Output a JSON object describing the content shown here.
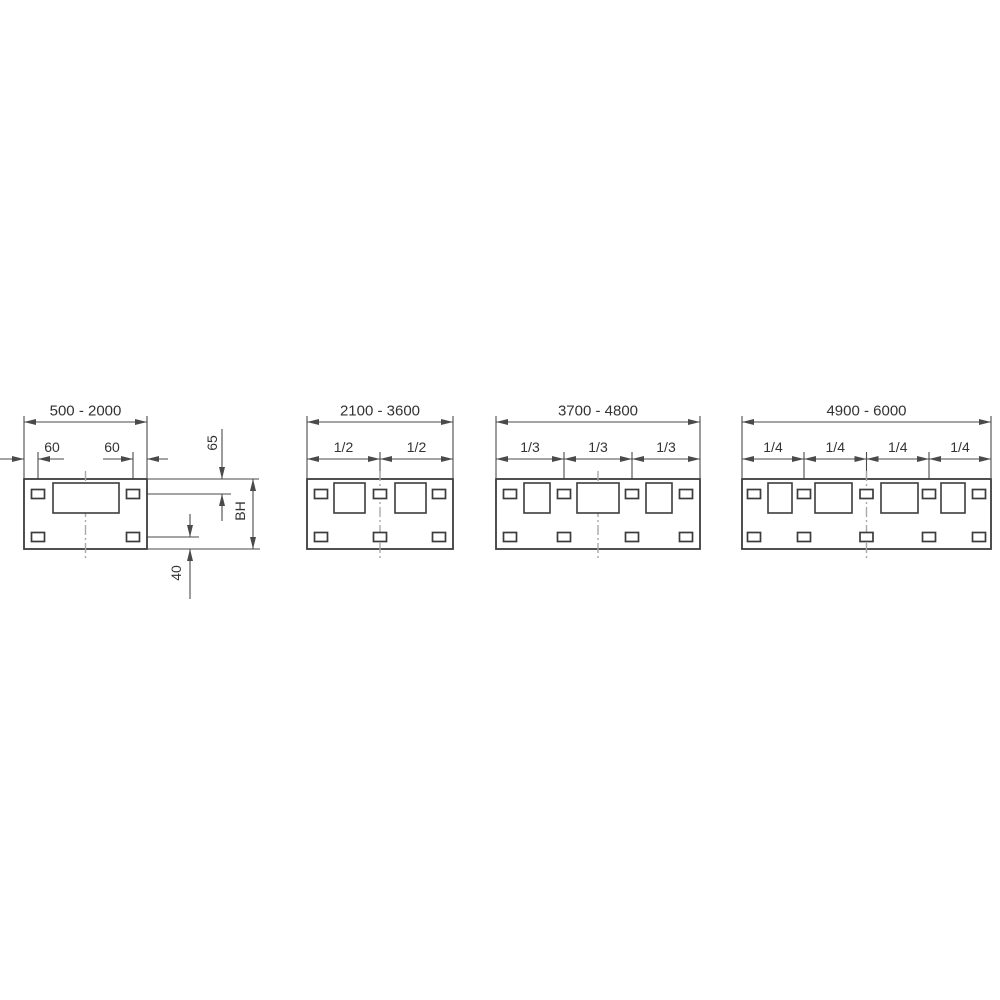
{
  "drawing": {
    "description_labels": {
      "range_labels": [
        "500 - 2000",
        "2100 - 3600",
        "3700 - 4800",
        "4900 - 6000"
      ],
      "fraction_labels": [
        "1/2",
        "1/3",
        "1/4"
      ],
      "offset_labels": [
        "60",
        "60"
      ],
      "side_labels": [
        "65",
        "BH",
        "40"
      ]
    },
    "styles": {
      "outline_color": "#3c3c3c",
      "dim_color": "#4a4a4a",
      "centerline_color": "#a8a8a8",
      "text_color": "#333333",
      "background": "#ffffff"
    },
    "layout": {
      "frame_y1": 479,
      "frame_y2": 549,
      "dim_line_y": 422,
      "range_label_y": 411,
      "sub_dim_y": 459,
      "sub_label_y": 447,
      "ext_top_y": 416,
      "div_ext_y1": 452,
      "slot_w": 13,
      "slot_h": 9,
      "slot_row_top_y": 494,
      "slot_row_bottom_y": 537,
      "cutout_y1": 483,
      "cutout_y2": 513,
      "centerline_y1": 471,
      "centerline_y2": 558,
      "range_font": 15,
      "sub_font": 14,
      "arrow_len": 12,
      "arrow_halfwidth": 3
    },
    "panels": [
      {
        "id": "500-2000",
        "range_label": "500 - 2000",
        "x1": 24,
        "x2": 147,
        "center_x": 85.5,
        "slots_x": [
          38,
          133
        ],
        "cutouts": [
          [
            53,
            119
          ]
        ],
        "divisions": [],
        "division_label": "",
        "offset_dims": [
          {
            "label": "60",
            "a": 24,
            "b": 38,
            "tails": [
              [
                0,
                24
              ],
              [
                38,
                64
              ]
            ],
            "text_x": 52
          },
          {
            "label": "60",
            "a": 133,
            "b": 147,
            "tails": [
              [
                103,
                133
              ],
              [
                147,
                168
              ]
            ],
            "text_x": 112
          }
        ],
        "side_dims": [
          {
            "label": "65",
            "x": 222,
            "a": 479,
            "b": 494,
            "style": "outside",
            "tails": [
              [
                429,
                479
              ],
              [
                494,
                521
              ]
            ],
            "text_x": 212,
            "text_y": 443
          },
          {
            "label": "BH",
            "x": 253,
            "a": 479,
            "b": 549,
            "style": "inside",
            "tails": [],
            "text_x": 240,
            "text_y": 511
          },
          {
            "label": "40",
            "x": 190,
            "a": 537,
            "b": 549,
            "style": "outside",
            "tails": [
              [
                514,
                537
              ],
              [
                549,
                599
              ]
            ],
            "text_x": 176,
            "text_y": 573
          }
        ],
        "ext_lines": [
          {
            "o": "h",
            "y": 479,
            "x1": 148,
            "x2": 259
          },
          {
            "o": "h",
            "y": 494,
            "x1": 141,
            "x2": 231
          },
          {
            "o": "h",
            "y": 537,
            "x1": 141,
            "x2": 199
          },
          {
            "o": "h",
            "y": 549,
            "x1": 148,
            "x2": 260
          },
          {
            "o": "v",
            "x": 38,
            "y1": 452,
            "y2": 489
          },
          {
            "o": "v",
            "x": 133,
            "y1": 452,
            "y2": 489
          }
        ]
      },
      {
        "id": "2100-3600",
        "range_label": "2100 - 3600",
        "x1": 307,
        "x2": 453,
        "center_x": 380,
        "slots_x": [
          321,
          380,
          439
        ],
        "cutouts": [
          [
            334,
            365
          ],
          [
            395,
            426
          ]
        ],
        "divisions": [
          380
        ],
        "division_label": "1/2",
        "offset_dims": [],
        "side_dims": [],
        "ext_lines": []
      },
      {
        "id": "3700-4800",
        "range_label": "3700 - 4800",
        "x1": 496,
        "x2": 700,
        "center_x": 598,
        "slots_x": [
          510,
          564,
          632,
          686
        ],
        "cutouts": [
          [
            524,
            550
          ],
          [
            577,
            619
          ],
          [
            646,
            672
          ]
        ],
        "divisions": [
          564,
          632
        ],
        "division_label": "1/3",
        "offset_dims": [],
        "side_dims": [],
        "ext_lines": []
      },
      {
        "id": "4900-6000",
        "range_label": "4900 - 6000",
        "x1": 742,
        "x2": 991,
        "center_x": 866.5,
        "slots_x": [
          754,
          804,
          866.5,
          929,
          979
        ],
        "cutouts": [
          [
            768,
            792
          ],
          [
            815,
            852
          ],
          [
            881,
            918
          ],
          [
            941,
            965
          ]
        ],
        "divisions": [
          804,
          866.5,
          929
        ],
        "division_label": "1/4",
        "offset_dims": [],
        "side_dims": [],
        "ext_lines": []
      }
    ]
  }
}
